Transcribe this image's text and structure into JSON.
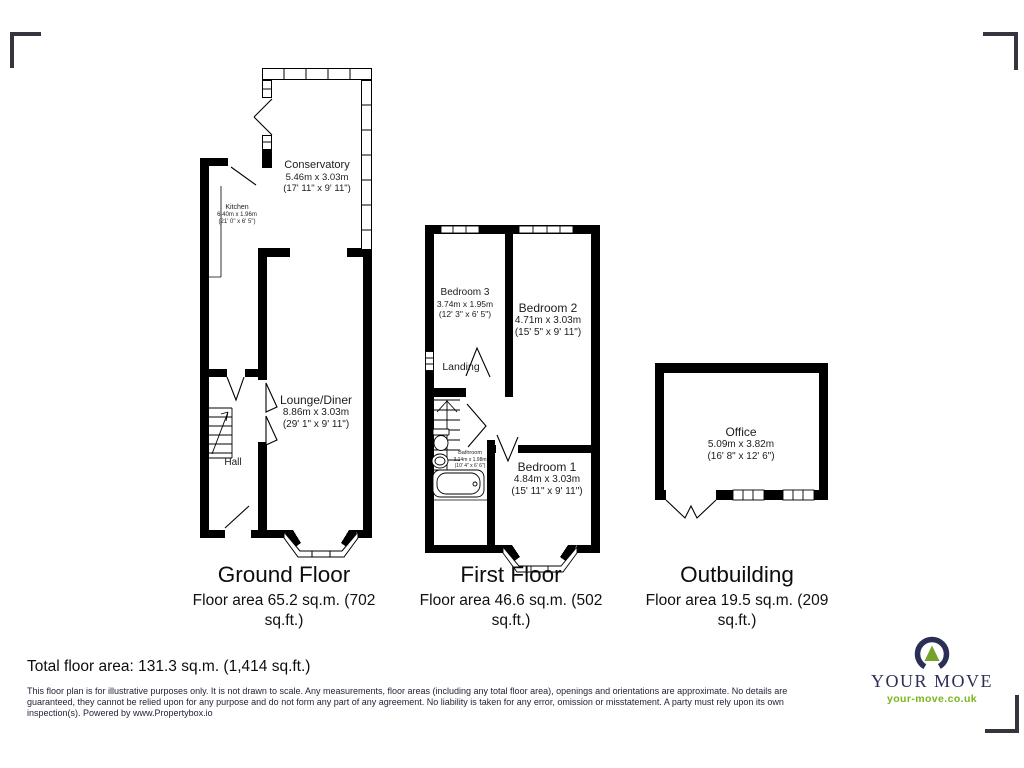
{
  "plans": {
    "ground": {
      "title": "Ground Floor",
      "area_line1": "Floor area 65.2 sq.m. (702",
      "area_line2": "sq.ft.)",
      "rooms": {
        "conservatory": {
          "name": "Conservatory",
          "metric": "5.46m x 3.03m",
          "imperial": "(17' 11\" x 9' 11\")"
        },
        "kitchen": {
          "name": "Kitchen",
          "metric": "6.40m x 1.96m",
          "imperial": "(21' 0\" x 6' 5\")"
        },
        "lounge": {
          "name": "Lounge/Diner",
          "metric": "8.86m x 3.03m",
          "imperial": "(29' 1\" x 9' 11\")"
        },
        "hall": {
          "name": "Hall"
        }
      }
    },
    "first": {
      "title": "First Floor",
      "area_line1": "Floor area 46.6 sq.m. (502",
      "area_line2": "sq.ft.)",
      "rooms": {
        "bedroom3": {
          "name": "Bedroom 3",
          "metric": "3.74m x 1.95m",
          "imperial": "(12' 3\" x 6' 5\")"
        },
        "bedroom2": {
          "name": "Bedroom 2",
          "metric": "4.71m x 3.03m",
          "imperial": "(15' 5\" x 9' 11\")"
        },
        "landing": {
          "name": "Landing"
        },
        "bathroom": {
          "name": "Bathroom",
          "metric": "3.14m x 1.98m",
          "imperial": "(10' 4\" x 6' 6\")"
        },
        "bedroom1": {
          "name": "Bedroom 1",
          "metric": "4.84m x 3.03m",
          "imperial": "(15' 11\" x 9' 11\")"
        }
      }
    },
    "outbuilding": {
      "title": "Outbuilding",
      "area_line1": "Floor area 19.5 sq.m. (209",
      "area_line2": "sq.ft.)",
      "rooms": {
        "office": {
          "name": "Office",
          "metric": "5.09m x 3.82m",
          "imperial": "(16' 8\" x 12' 6\")"
        }
      }
    }
  },
  "footer": {
    "total_area": "Total floor area: 131.3 sq.m. (1,414 sq.ft.)",
    "disclaimer_line1": "This floor plan is for illustrative purposes only. It is not drawn to scale. Any measurements, floor areas (including any total floor area), openings and orientations are approximate. No details are",
    "disclaimer_line2": "guaranteed, they cannot be relied upon for any purpose and do not form any part of any agreement. No liability is taken for any error, omission or misstatement. A party must rely upon its own",
    "disclaimer_line3": "inspection(s). Powered by www.Propertybox.io"
  },
  "logo": {
    "brand": "YOUR MOVE",
    "website": "your-move.co.uk",
    "navy": "#2c2f55",
    "green": "#7ab51d"
  },
  "colors": {
    "wall": "#000000"
  }
}
